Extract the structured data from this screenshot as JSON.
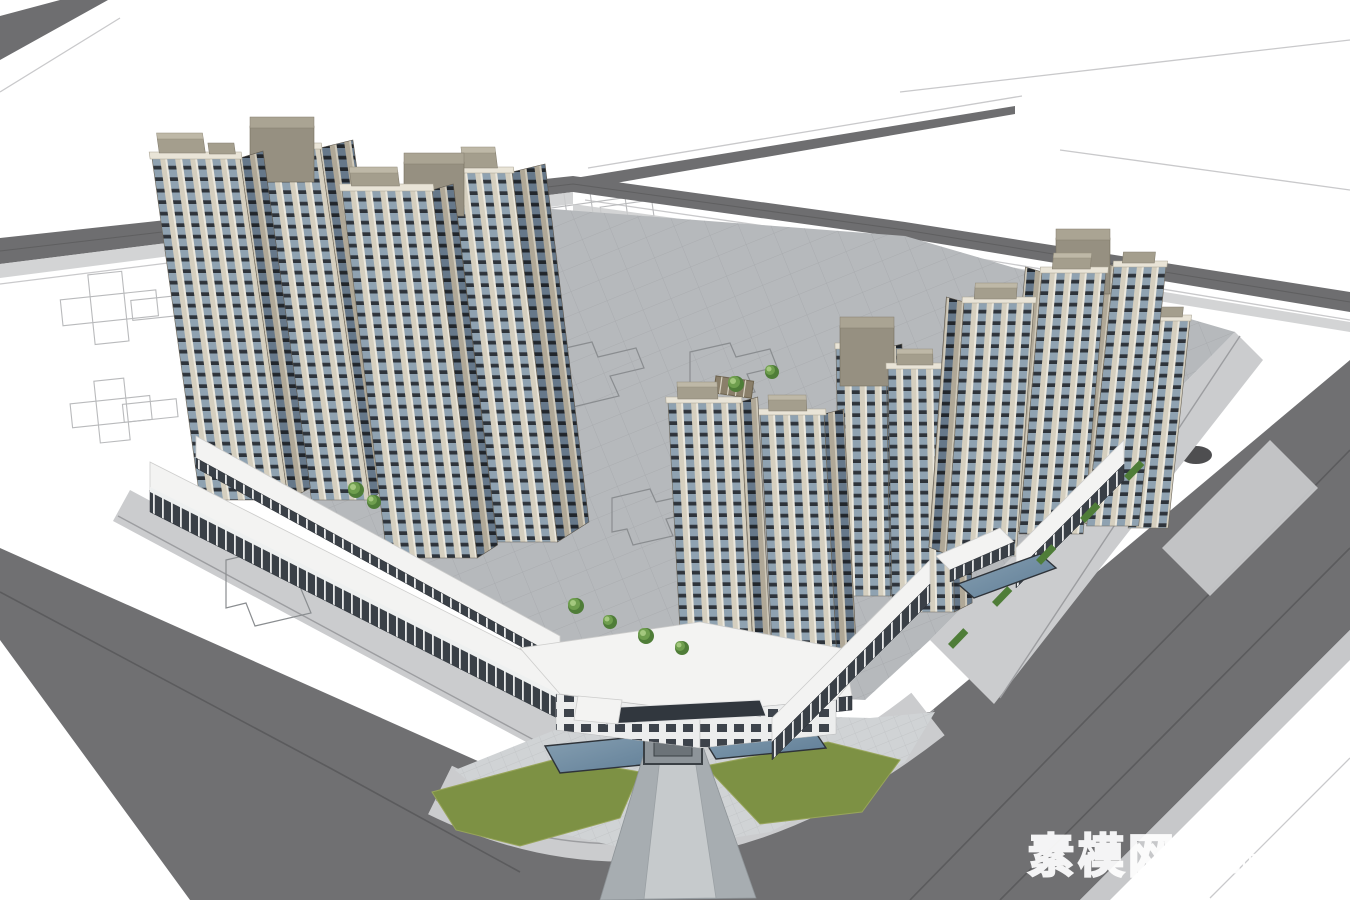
{
  "meta": {
    "description": "Aerial SketchUp-style massing render of a corner residential development: tall tan-and-glass towers, mid-rise blocks, perimeter retail podium, corner commercial entrance with water pools and lawns, gray streets and white context blocks with wireframe footprints."
  },
  "watermark": {
    "cjk": "素模网",
    "latin": "suuuum.com"
  },
  "scene": {
    "left_tall_towers": 4,
    "middle_towers": 4,
    "right_towers": 4,
    "features": [
      "perimeter-retail-podium",
      "corner-commercial-entrance",
      "entry-water-pools",
      "lawn-wedges",
      "courtyard-with-footprint-outlines",
      "street-planting-strips",
      "context-blocks-wireframe"
    ]
  },
  "palette": {
    "background": "#ffffff",
    "road": "#707072",
    "road_far": "#6e6e70",
    "road_line": "#5b5b5d",
    "verge": "#c7c8ca",
    "sidewalk": "#cbccce",
    "curb": "#9c9da0",
    "plaza": "#d0d3d5",
    "courtyard": "#b6b9bc",
    "pave_line": "#a6a9ac",
    "footprint_line": "#8a8d90",
    "wireframe": "#b9babc",
    "block_line": "#c9c9cb",
    "facade_tan": "#d5cfbf",
    "facade_white": "#ece8dd",
    "glass_blue": "#8fa2b1",
    "spandrel": "#2e343b",
    "facade_tan_dark": "#b0a897",
    "glass_dark": "#66788a",
    "spandrel_dark": "#21262c",
    "parapet": "#e9e4d7",
    "roof_tan": "#a49e8d",
    "roof_tan_top": "#beb8a7",
    "roof_gray": "#969081",
    "roof_gray_top": "#aaa493",
    "roof_white": "#f3f3f2",
    "storefront": "#3a4047",
    "mullion_white": "#e9eaea",
    "com_white": "#eceded",
    "com_glass": "#3d434b",
    "canopy_dark": "#31373e",
    "lawn": "#7d9144",
    "lawn_light": "#98a55b",
    "tree": "#6f9e4e",
    "tree_light": "#a4c87f",
    "tree_dark": "#4f7d38",
    "pool": "#5f7d96",
    "pool_light": "#87a0b2",
    "pool_rim": "#2e3339",
    "watermark": "#ffffff"
  }
}
